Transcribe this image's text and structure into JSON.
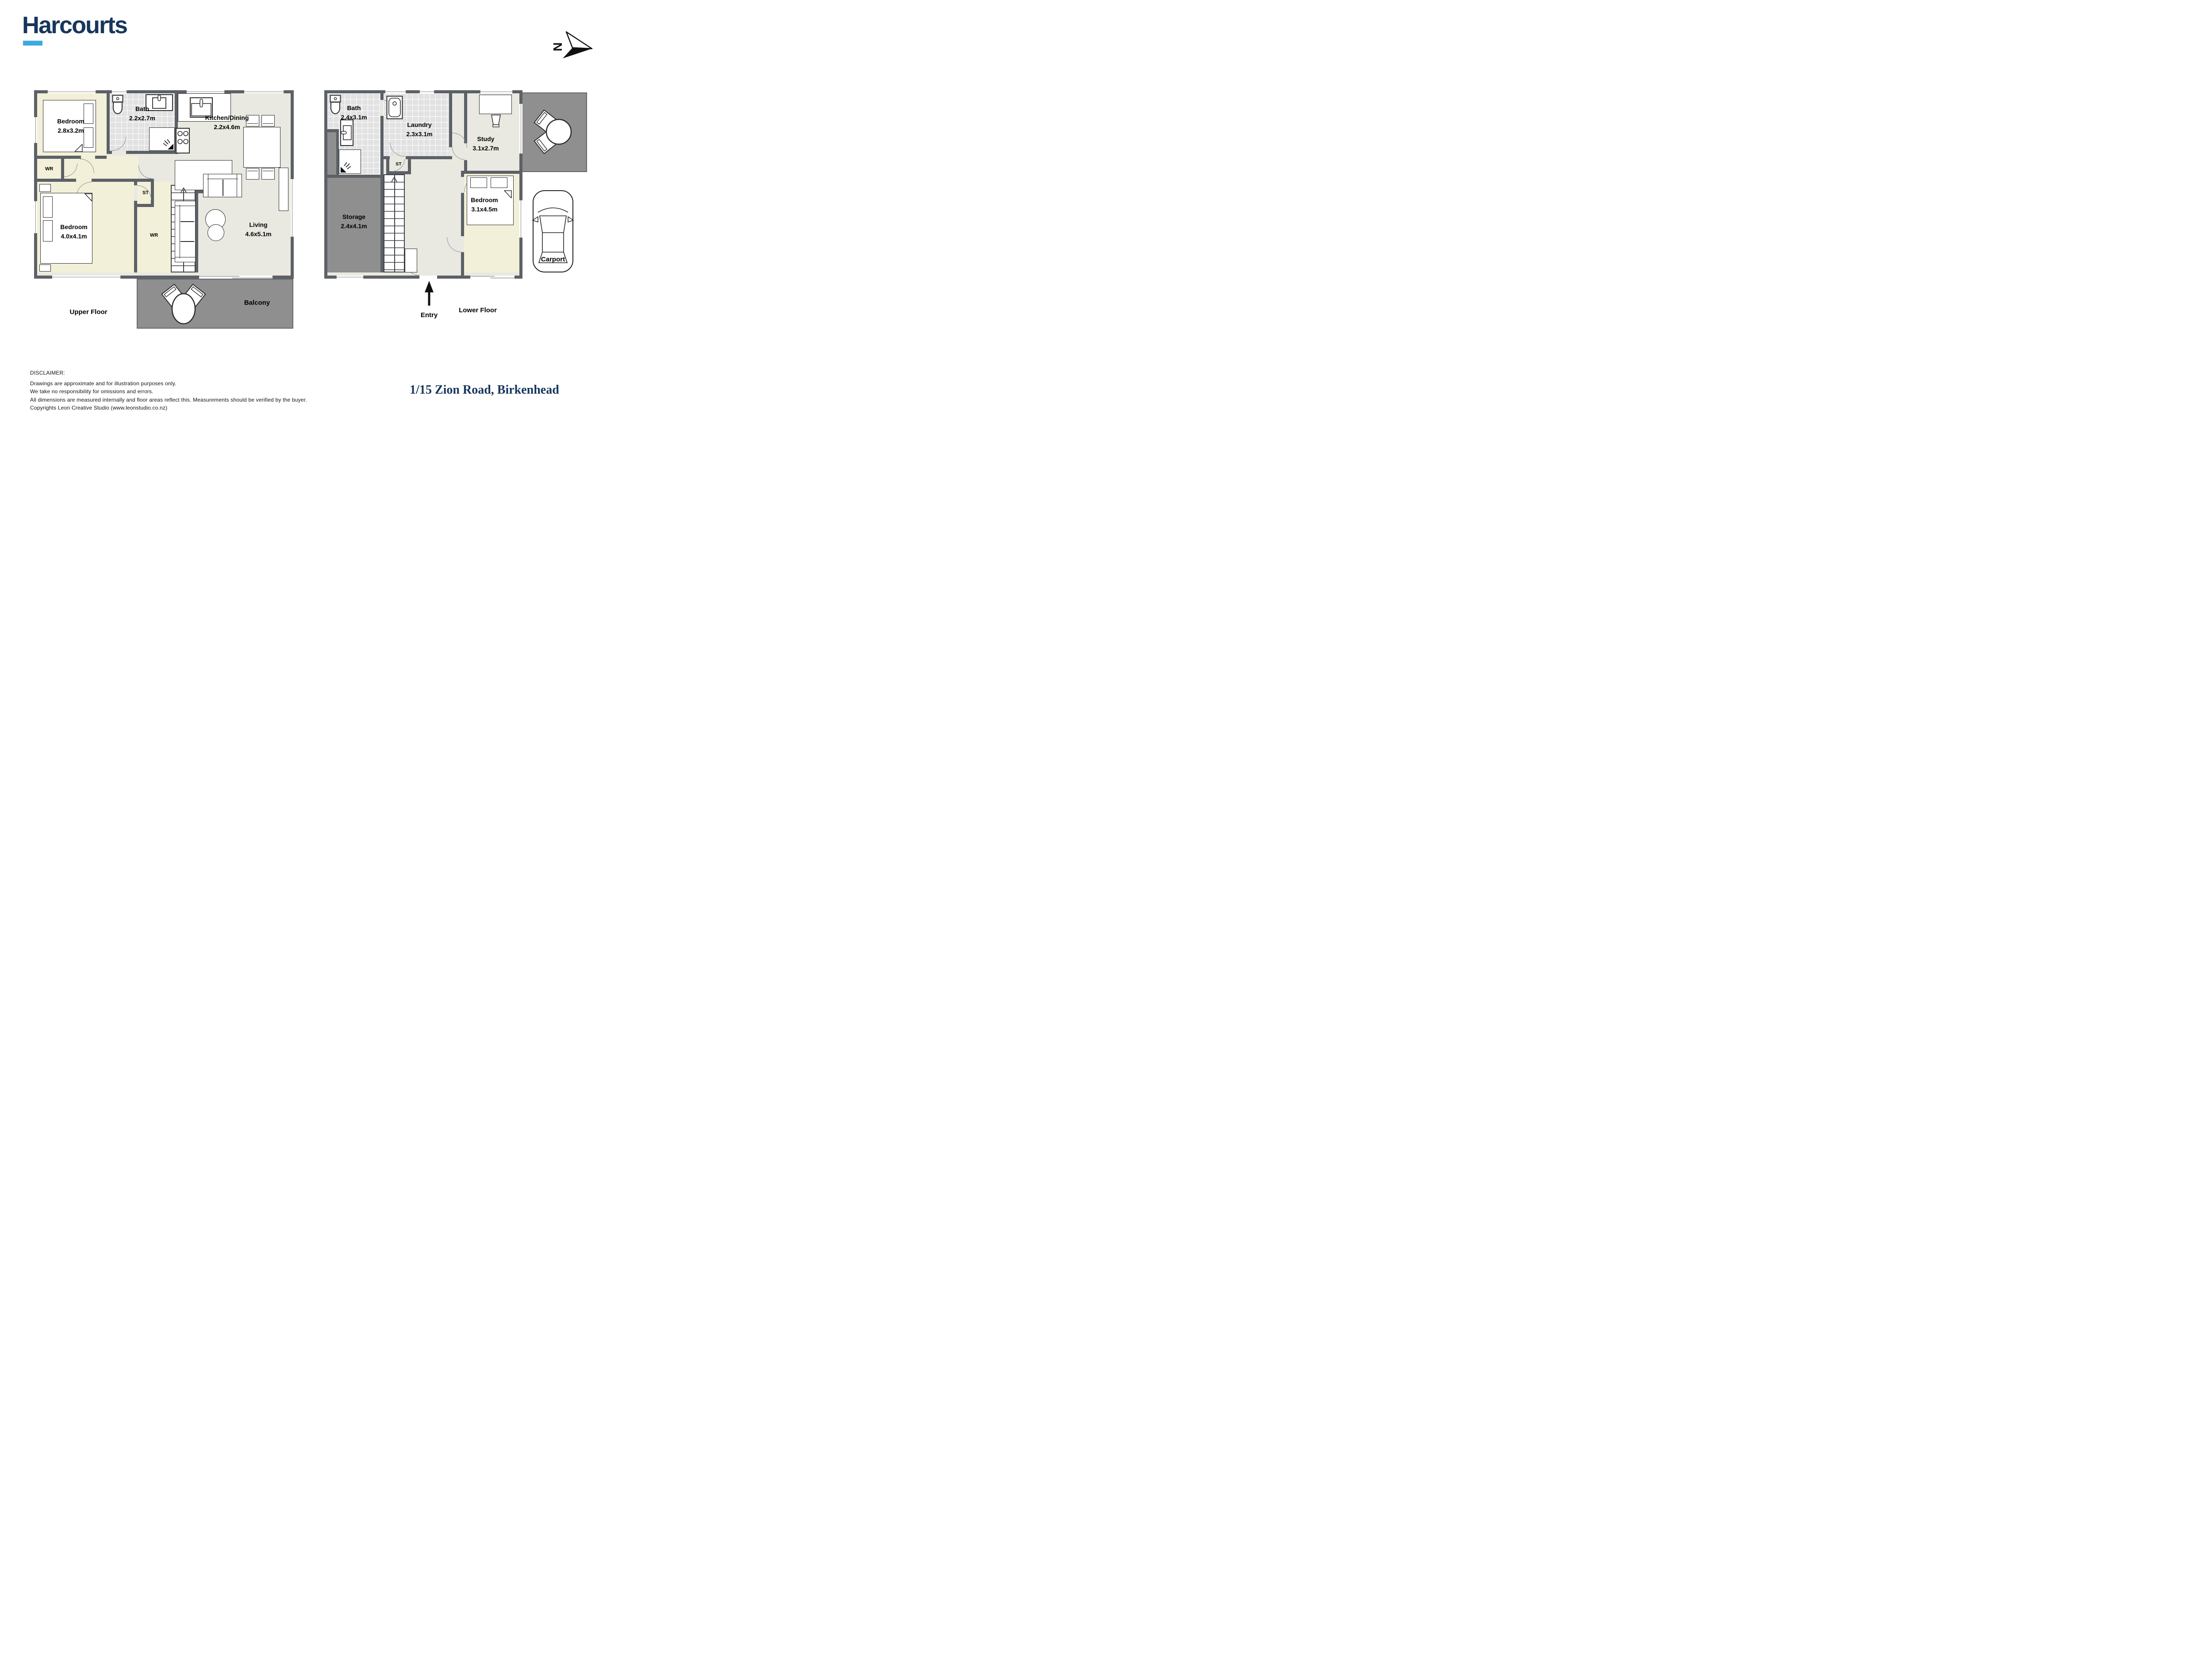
{
  "brand": {
    "name": "Harcourts"
  },
  "compass": {
    "letter": "N"
  },
  "address": "1/15 Zion Road, Birkenhead",
  "floors": {
    "upper": {
      "title": "Upper Floor",
      "rooms": {
        "bedroom1": {
          "name": "Bedroom",
          "dims": "2.8x3.2m"
        },
        "bath": {
          "name": "Bath",
          "dims": "2.2x2.7m"
        },
        "kitchen_dining": {
          "name": "Kitchen/Dining",
          "dims": "2.2x4.6m"
        },
        "living": {
          "name": "Living",
          "dims": "4.6x5.1m"
        },
        "bedroom2": {
          "name": "Bedroom",
          "dims": "4.0x4.1m"
        },
        "wr_closet": "WR",
        "wr_wardrobe": "WR",
        "st": "ST",
        "balcony": "Balcony"
      }
    },
    "lower": {
      "title": "Lower Floor",
      "rooms": {
        "bath": {
          "name": "Bath",
          "dims": "2.4x3.1m"
        },
        "laundry": {
          "name": "Laundry",
          "dims": "2.3x3.1m"
        },
        "study": {
          "name": "Study",
          "dims": "3.1x2.7m"
        },
        "storage": {
          "name": "Storage",
          "dims": "2.4x4.1m"
        },
        "bedroom": {
          "name": "Bedroom",
          "dims": "3.1x4.5m"
        },
        "st": "ST",
        "carport": "Carport",
        "entry": "Entry"
      }
    }
  },
  "footer": {
    "disclaimer_title": "DISCLAIMER:",
    "disclaimer_lines": [
      "Drawings are approximate and for illustration purposes only.",
      "We take no responsibility for omissions and errors.",
      "All dimensions are measured internally and floor areas reflect this. Measurements should be verified by the buyer.",
      "Copyrights Leon Creative Studio (www.leonstudio.co.nz)"
    ]
  },
  "colors": {
    "wall": "#5c6167",
    "cream": "#f3f0d9",
    "tile": "#e2e2e2",
    "sage": "#e9e9e1",
    "outdoor_gray": "#8f8f8f",
    "navy": "#17365c",
    "accent_blue": "#3fa9e0"
  }
}
